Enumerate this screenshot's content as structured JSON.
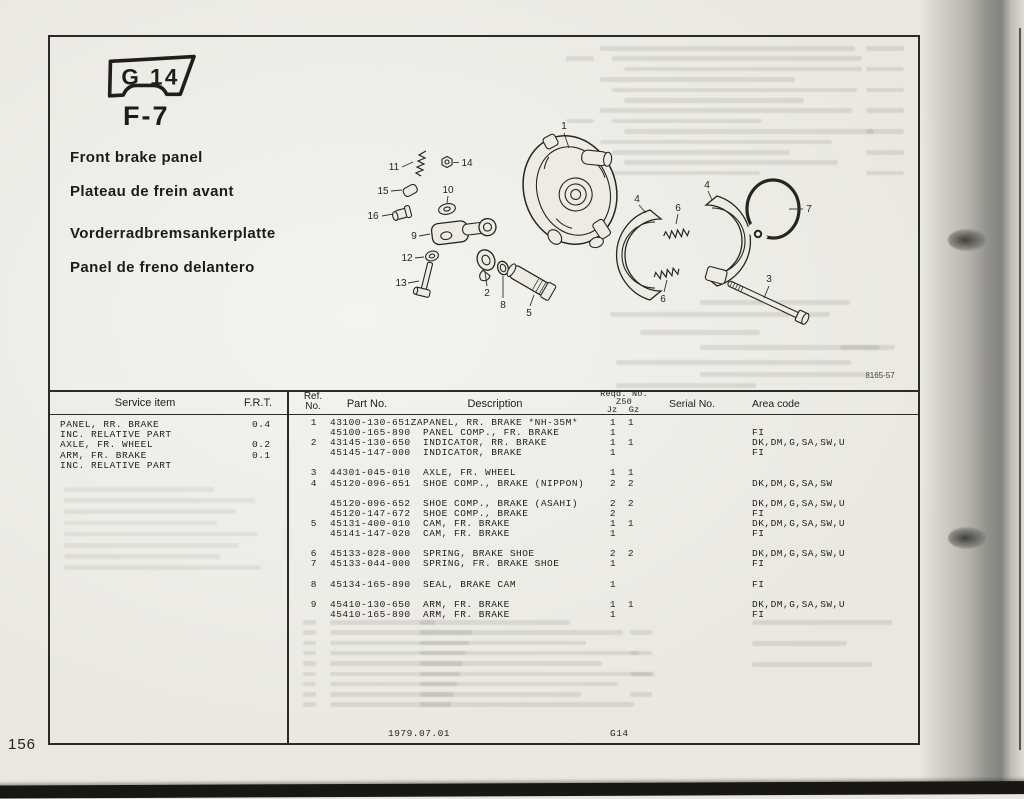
{
  "page": {
    "section_badge": "G 14",
    "page_code": "F-7",
    "titles": [
      "Front brake panel",
      "Plateau de frein avant",
      "Vorderradbremsankerplatte",
      "Panel de freno delantero"
    ],
    "figure_number": "8165-57",
    "page_number": "156",
    "footer_date": "1979.07.01",
    "footer_code": "G14"
  },
  "colors": {
    "paper": "#edebe4",
    "ink": "#201f1d",
    "line": "#2a2a28"
  },
  "diagram": {
    "labels": {
      "n1": "1",
      "n2": "2",
      "n3": "3",
      "n4": "4",
      "n5": "5",
      "n6": "6",
      "n7": "7",
      "n8": "8",
      "n9": "9",
      "n10": "10",
      "n11": "11",
      "n12": "12",
      "n13": "13",
      "n14": "14",
      "n15": "15",
      "n16": "16"
    }
  },
  "table": {
    "headers": {
      "service_item": "Service item",
      "frt": "F.R.T.",
      "ref_line1": "Ref.",
      "ref_line2": "No.",
      "part_no": "Part No.",
      "description": "Description",
      "reqd_no": "Reqd. No.",
      "reqd_model": "Z50",
      "qty_col1": "Jz",
      "qty_col2": "Gz",
      "serial_no": "Serial No.",
      "area_code": "Area code"
    },
    "service_items": [
      {
        "name": "PANEL, RR. BRAKE",
        "frt": "0.4"
      },
      {
        "name": "INC. RELATIVE PART",
        "frt": ""
      },
      {
        "name": "AXLE, FR. WHEEL",
        "frt": "0.2"
      },
      {
        "name": "ARM, FR. BRAKE",
        "frt": "0.1"
      },
      {
        "name": "INC. RELATIVE PART",
        "frt": ""
      }
    ],
    "rows": [
      {
        "ref": "1",
        "part": "43100-130-651ZA",
        "desc": "PANEL, RR. BRAKE *NH-35M*",
        "jz": "1",
        "gz": "1",
        "serial": "",
        "area": ""
      },
      {
        "ref": "",
        "part": "45100-165-890",
        "desc": "PANEL COMP., FR. BRAKE",
        "jz": "1",
        "gz": "",
        "serial": "",
        "area": "FI"
      },
      {
        "ref": "2",
        "part": "43145-130-650",
        "desc": "INDICATOR, RR. BRAKE",
        "jz": "1",
        "gz": "1",
        "serial": "",
        "area": "DK,DM,G,SA,SW,U"
      },
      {
        "ref": "",
        "part": "45145-147-000",
        "desc": "INDICATOR, BRAKE",
        "jz": "1",
        "gz": "",
        "serial": "",
        "area": "FI"
      },
      {
        "spacer": true
      },
      {
        "ref": "3",
        "part": "44301-045-010",
        "desc": "AXLE, FR. WHEEL",
        "jz": "1",
        "gz": "1",
        "serial": "",
        "area": ""
      },
      {
        "ref": "4",
        "part": "45120-096-651",
        "desc": "SHOE COMP., BRAKE (NIPPON)",
        "jz": "2",
        "gz": "2",
        "serial": "",
        "area": "DK,DM,G,SA,SW"
      },
      {
        "spacer": true
      },
      {
        "ref": "",
        "part": "45120-096-652",
        "desc": "SHOE COMP., BRAKE (ASAHI)",
        "jz": "2",
        "gz": "2",
        "serial": "",
        "area": "DK,DM,G,SA,SW,U"
      },
      {
        "ref": "",
        "part": "45120-147-672",
        "desc": "SHOE COMP., BRAKE",
        "jz": "2",
        "gz": "",
        "serial": "",
        "area": "FI"
      },
      {
        "ref": "5",
        "part": "45131-400-010",
        "desc": "CAM, FR. BRAKE",
        "jz": "1",
        "gz": "1",
        "serial": "",
        "area": "DK,DM,G,SA,SW,U"
      },
      {
        "ref": "",
        "part": "45141-147-020",
        "desc": "CAM, FR. BRAKE",
        "jz": "1",
        "gz": "",
        "serial": "",
        "area": "FI"
      },
      {
        "spacer": true
      },
      {
        "ref": "6",
        "part": "45133-028-000",
        "desc": "SPRING, BRAKE SHOE",
        "jz": "2",
        "gz": "2",
        "serial": "",
        "area": "DK,DM,G,SA,SW,U"
      },
      {
        "ref": "7",
        "part": "45133-044-000",
        "desc": "SPRING, FR. BRAKE SHOE",
        "jz": "1",
        "gz": "",
        "serial": "",
        "area": "FI"
      },
      {
        "spacer": true
      },
      {
        "ref": "8",
        "part": "45134-165-890",
        "desc": "SEAL, BRAKE CAM",
        "jz": "1",
        "gz": "",
        "serial": "",
        "area": "FI"
      },
      {
        "spacer": true
      },
      {
        "ref": "9",
        "part": "45410-130-650",
        "desc": "ARM, FR. BRAKE",
        "jz": "1",
        "gz": "1",
        "serial": "",
        "area": "DK,DM,G,SA,SW,U"
      },
      {
        "ref": "",
        "part": "45410-165-890",
        "desc": "ARM, FR. BRAKE",
        "jz": "1",
        "gz": "",
        "serial": "",
        "area": "FI"
      }
    ]
  }
}
